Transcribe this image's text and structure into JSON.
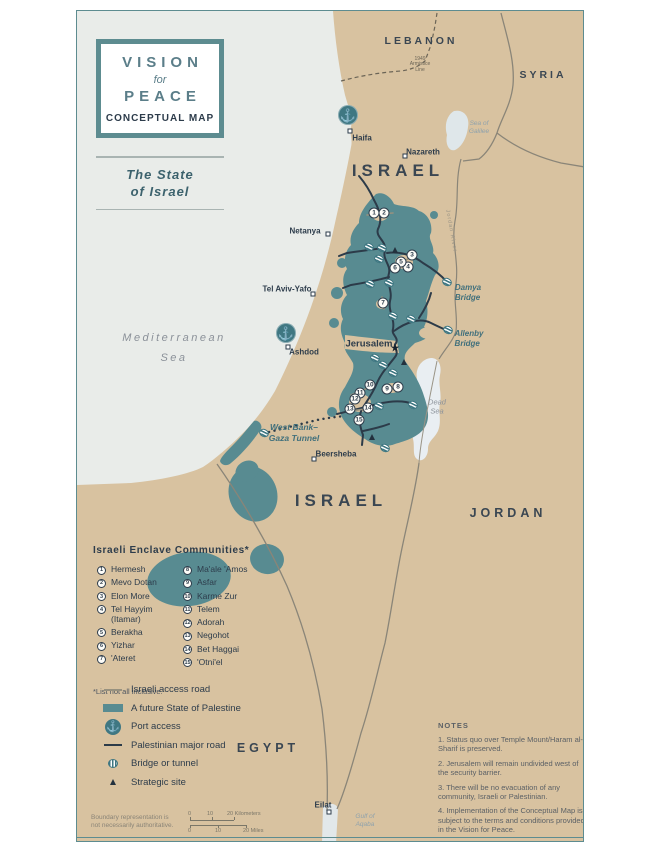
{
  "colors": {
    "land": "#d8c2a0",
    "sea": "#e9ece9",
    "palestine": "#588b91",
    "frame": "#5d8c90",
    "navy": "#2d3c4b",
    "teal_label": "#41707c",
    "light_water": "#e9eef2"
  },
  "map_title": {
    "vision": "VISION",
    "for": "for",
    "peace": "PEACE",
    "conceptual": "CONCEPTUAL MAP"
  },
  "subtitle": {
    "line1": "The State",
    "line2": "of Israel"
  },
  "countries": [
    {
      "id": "lebanon",
      "text": "LEBANON",
      "x": 420,
      "y": 40,
      "size": 10.5,
      "ls": 3
    },
    {
      "id": "syria",
      "text": "SYRIA",
      "x": 542,
      "y": 74,
      "size": 10.5,
      "ls": 3
    },
    {
      "id": "israel-north",
      "text": "ISRAEL",
      "x": 397,
      "y": 170,
      "size": 17,
      "ls": 5
    },
    {
      "id": "israel-south",
      "text": "ISRAEL",
      "x": 340,
      "y": 500,
      "size": 17,
      "ls": 5
    },
    {
      "id": "jordan",
      "text": "JORDAN",
      "x": 507,
      "y": 512,
      "size": 12.5,
      "ls": 4
    },
    {
      "id": "egypt",
      "text": "EGYPT",
      "x": 267,
      "y": 747,
      "size": 12.5,
      "ls": 4
    }
  ],
  "water_labels": [
    {
      "id": "mediterranean",
      "text": "Mediterranean",
      "x": 173,
      "y": 338,
      "size": 11,
      "ls": 2.5,
      "kind": "gray"
    },
    {
      "id": "mediterranean-sea",
      "text": "Sea",
      "x": 173,
      "y": 358,
      "size": 11,
      "ls": 2.5,
      "kind": "gray"
    },
    {
      "id": "sea-of-galilee",
      "text": "Sea of\nGalilee",
      "x": 478,
      "y": 127,
      "size": 6.5,
      "ls": 0,
      "kind": "teal"
    },
    {
      "id": "dead-sea",
      "text": "Dead\nSea",
      "x": 436,
      "y": 406,
      "size": 7.5,
      "ls": 0,
      "kind": "gray"
    },
    {
      "id": "gulf-of-aqaba",
      "text": "Gulf of\nAqaba",
      "x": 364,
      "y": 820,
      "size": 6.5,
      "ls": 0,
      "kind": "teal"
    }
  ],
  "bridge_labels": [
    {
      "id": "damya-bridge",
      "text": "Damya\nBridge",
      "x": 467,
      "y": 292
    },
    {
      "id": "allenby-bridge",
      "text": "Allenby\nBridge",
      "x": 468,
      "y": 338
    }
  ],
  "misc_labels": [
    {
      "id": "tunnel-label",
      "kind": "tunnel",
      "text": "West Bank–\nGaza Tunnel",
      "x": 293,
      "y": 432,
      "rot": 0
    },
    {
      "id": "armistice-line",
      "kind": "armistice",
      "text": "1949\nArmistice\nLine",
      "x": 419,
      "y": 64,
      "rot": 0
    },
    {
      "id": "jordan-river",
      "kind": "river",
      "text": "Jordan River",
      "x": 450,
      "y": 230,
      "rot": 80
    }
  ],
  "cities": [
    {
      "id": "haifa",
      "name": "Haifa",
      "lx": 361,
      "ly": 137,
      "dx": 349,
      "dy": 130,
      "big": false
    },
    {
      "id": "nazareth",
      "name": "Nazareth",
      "lx": 422,
      "ly": 151,
      "dx": 404,
      "dy": 155,
      "big": false
    },
    {
      "id": "netanya",
      "name": "Netanya",
      "lx": 304,
      "ly": 230,
      "dx": 327,
      "dy": 233,
      "big": false
    },
    {
      "id": "tel-aviv-yafo",
      "name": "Tel Aviv-Yafo",
      "lx": 286,
      "ly": 288,
      "dx": 312,
      "dy": 293,
      "big": false
    },
    {
      "id": "ashdod",
      "name": "Ashdod",
      "lx": 303,
      "ly": 351,
      "dx": 287,
      "dy": 346,
      "big": false
    },
    {
      "id": "beersheba",
      "name": "Beersheba",
      "lx": 335,
      "ly": 453,
      "dx": 313,
      "dy": 458,
      "big": false
    },
    {
      "id": "eilat",
      "name": "Eilat",
      "lx": 322,
      "ly": 804,
      "dx": 328,
      "dy": 811,
      "big": false
    },
    {
      "id": "jerusalem",
      "name": "Jerusalem",
      "lx": 368,
      "ly": 343,
      "dx": null,
      "dy": null,
      "big": true
    }
  ],
  "jerusalem_star": {
    "x": 394,
    "y": 348
  },
  "ports": [
    {
      "id": "port-haifa",
      "x": 347,
      "y": 114
    },
    {
      "id": "port-ashdod",
      "x": 285,
      "y": 332
    }
  ],
  "bridge_icons": [
    [
      368,
      246
    ],
    [
      381,
      247
    ],
    [
      378,
      258
    ],
    [
      369,
      283
    ],
    [
      388,
      282
    ],
    [
      446,
      281
    ],
    [
      392,
      315
    ],
    [
      410,
      318
    ],
    [
      447,
      329
    ],
    [
      374,
      357
    ],
    [
      382,
      364
    ],
    [
      392,
      372
    ],
    [
      378,
      405
    ],
    [
      412,
      404
    ],
    [
      384,
      447
    ],
    [
      263,
      432
    ]
  ],
  "markers": [
    {
      "n": "1",
      "x": 373,
      "y": 212
    },
    {
      "n": "2",
      "x": 383,
      "y": 212
    },
    {
      "n": "3",
      "x": 411,
      "y": 254
    },
    {
      "n": "4",
      "x": 407,
      "y": 266
    },
    {
      "n": "5",
      "x": 400,
      "y": 261
    },
    {
      "n": "6",
      "x": 394,
      "y": 267
    },
    {
      "n": "7",
      "x": 382,
      "y": 302
    },
    {
      "n": "8",
      "x": 397,
      "y": 386
    },
    {
      "n": "9",
      "x": 386,
      "y": 388
    },
    {
      "n": "10",
      "x": 369,
      "y": 384
    },
    {
      "n": "11",
      "x": 359,
      "y": 392
    },
    {
      "n": "12",
      "x": 354,
      "y": 398
    },
    {
      "n": "13",
      "x": 349,
      "y": 408
    },
    {
      "n": "14",
      "x": 367,
      "y": 407
    },
    {
      "n": "15",
      "x": 358,
      "y": 419
    }
  ],
  "strategic_sites": [
    [
      394,
      249
    ],
    [
      403,
      361
    ],
    [
      371,
      436
    ]
  ],
  "enclaves": {
    "heading": "Israeli Enclave Communities*",
    "col1": [
      {
        "num": "1",
        "name": "Hermesh"
      },
      {
        "num": "2",
        "name": "Mevo Dotan"
      },
      {
        "num": "3",
        "name": "Elon More"
      },
      {
        "num": "4",
        "name": "Tel Hayyim\n(Itamar)"
      },
      {
        "num": "5",
        "name": "Berakha"
      },
      {
        "num": "6",
        "name": "Yizhar"
      },
      {
        "num": "7",
        "name": "'Ateret"
      }
    ],
    "col2": [
      {
        "num": "8",
        "name": "Ma'ale 'Amos"
      },
      {
        "num": "9",
        "name": "Asfar"
      },
      {
        "num": "10",
        "name": "Karme Zur"
      },
      {
        "num": "11",
        "name": "Telem"
      },
      {
        "num": "12",
        "name": "Adorah"
      },
      {
        "num": "13",
        "name": "Negohot"
      },
      {
        "num": "14",
        "name": "Bet Haggai"
      },
      {
        "num": "15",
        "name": "'Otni'el"
      }
    ],
    "footnote": "*List not all inclusive."
  },
  "map_legend": {
    "items": [
      {
        "type": "road-gray",
        "label": "Israeli access road"
      },
      {
        "type": "fill",
        "label": "A future State of Palestine"
      },
      {
        "type": "port",
        "label": "Port access"
      },
      {
        "type": "road-dark",
        "label": "Palestinian major road"
      },
      {
        "type": "bridge",
        "label": "Bridge or tunnel"
      },
      {
        "type": "site",
        "label": "Strategic site"
      }
    ]
  },
  "notes": {
    "heading": "NOTES",
    "items": [
      "1. Status quo over Temple Mount/Haram al-Sharif is preserved.",
      "2. Jerusalem will remain undivided west of the security barrier.",
      "3. There will be no evacuation of any community, Israeli or Palestinian.",
      "4. Implementation of the Conceptual Map is subject to the terms and conditions provided in the Vision for Peace."
    ]
  },
  "footer": {
    "disclaimer": "Boundary representation is\nnot necessarily authoritative.",
    "scale": {
      "km0": "0",
      "km10": "10",
      "km20": "20 Kilometers",
      "mi0": "0",
      "mi10": "10",
      "mi20": "20 Miles"
    }
  }
}
